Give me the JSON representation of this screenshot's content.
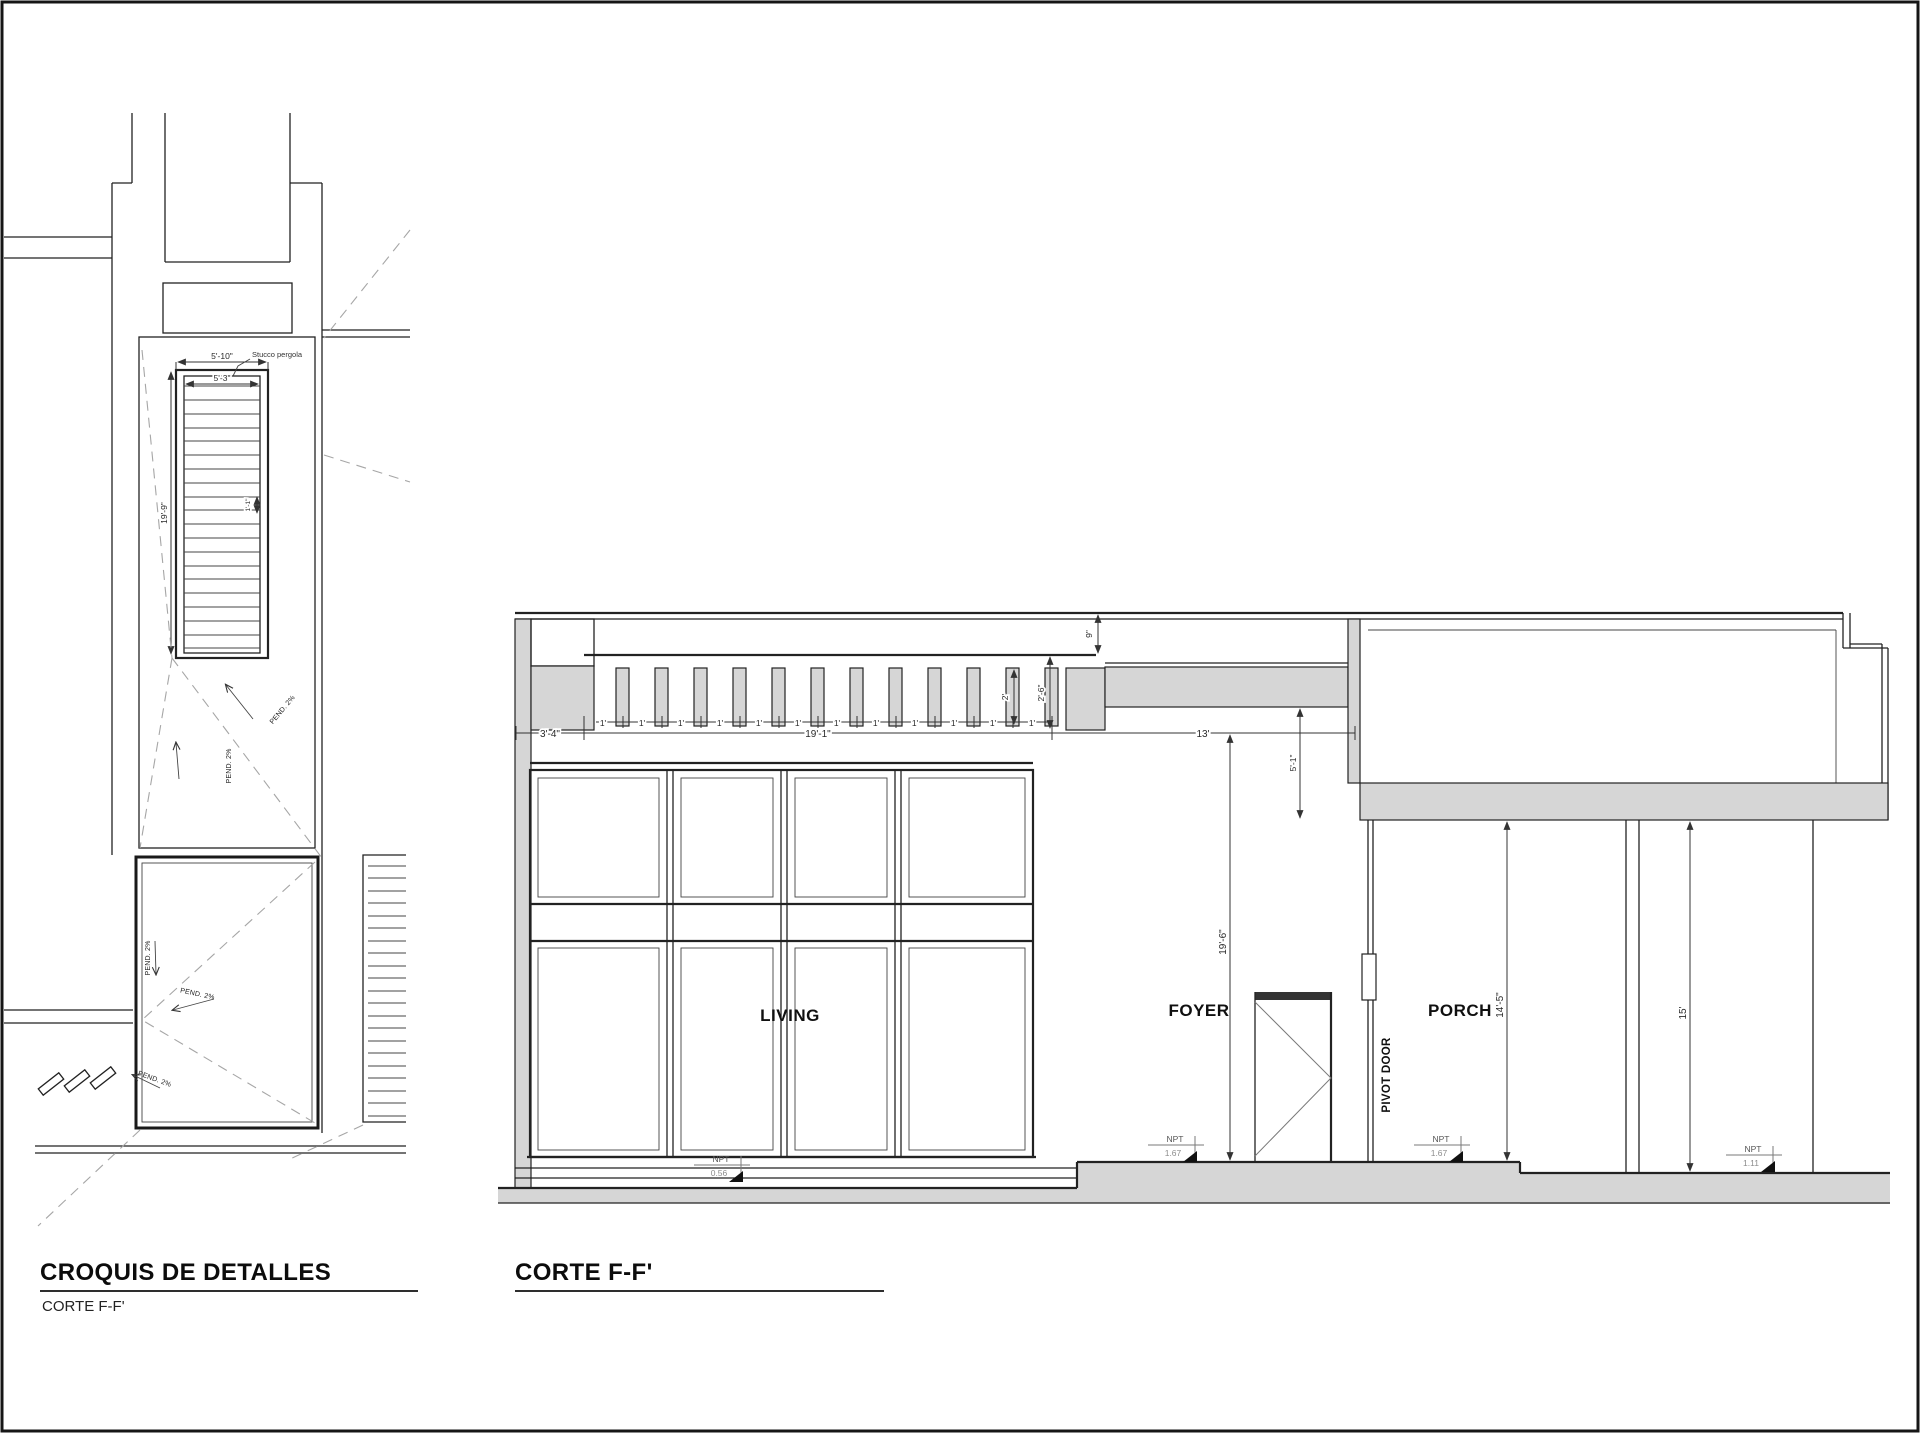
{
  "colors": {
    "line": "#222222",
    "fill_gray": "#d6d6d6",
    "dashed": "#a6a6a6",
    "background": "#ffffff"
  },
  "left_drawing": {
    "title": "CROQUIS DE DETALLES",
    "subtitle": "CORTE F-F'",
    "pergola_label": "Stucco pergola",
    "slope_label": "PEND. 2%",
    "dims": {
      "outer_width": "5'-10\"",
      "inner_width": "5'-3\"",
      "length": "19'-9\"",
      "slat_gap": "1'-1\""
    }
  },
  "right_drawing": {
    "title": "CORTE F-F'",
    "rooms": {
      "living": "LIVING",
      "foyer": "FOYER",
      "porch": "PORCH"
    },
    "pivot_door_label": "PIVOT DOOR",
    "dims": {
      "left_offset": "3'-4\"",
      "pergola_total": "19'-1\"",
      "module": "1'",
      "slat_height": "2'",
      "pergola_drop": "2'-6\"",
      "roof_edge": "9\"",
      "beam_drop": "5'-1\"",
      "foyer_width": "13'",
      "foyer_height": "19'-6\"",
      "porch_height": "14'-5\"",
      "right_height": "15'"
    },
    "levels": {
      "label": "NPT",
      "living": "0.56",
      "foyer": "1.67",
      "porch": "1.67",
      "exterior": "1.11"
    }
  }
}
